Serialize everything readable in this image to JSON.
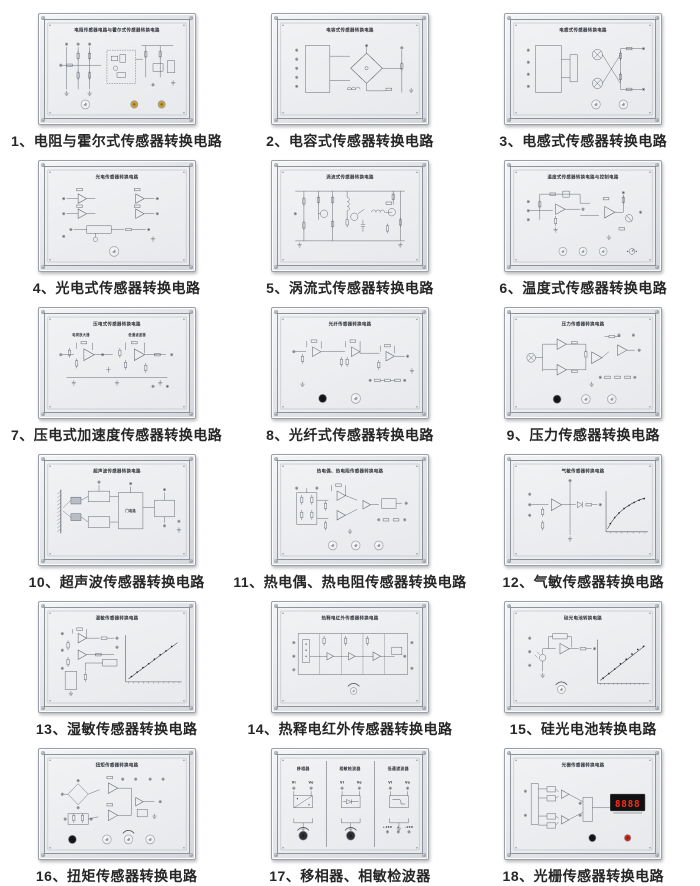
{
  "page": {
    "background": "#ffffff"
  },
  "colors": {
    "panel_frame": "#d9dbdf",
    "panel_plate": "#edeff2",
    "schematic_line": "#555a63",
    "caption_text": "#262626",
    "knob_white": "#eef0f2",
    "knob_yellow": "#c9a13b",
    "knob_black": "#17181a",
    "knob_dark": "#2f3136",
    "knob_red": "#d02418",
    "display_bg": "#111111",
    "display_digits_red": "#ff2a1a"
  },
  "panels": [
    {
      "caption": "1、电阻与霍尔式传感器转换电路",
      "title": "电阻传感器电路与霍尔式传感器转换电路",
      "motif": "hall",
      "knobs": [
        "white",
        "yellow",
        "yellow"
      ]
    },
    {
      "caption": "2、电容式传感器转换电路",
      "title": "电容式传感器转换电路",
      "motif": "bridge",
      "knobs": []
    },
    {
      "caption": "3、电感式传感器转换电路",
      "title": "电感式传感器转换电路",
      "motif": "inductive",
      "knobs": [
        "white",
        "white"
      ]
    },
    {
      "caption": "4、光电式传感器转换电路",
      "title": "光电传感器转换电路",
      "motif": "photo",
      "knobs": [
        "white"
      ]
    },
    {
      "caption": "5、涡流式传感器转换电路",
      "title": "涡流式传感器转换电路",
      "motif": "eddy",
      "knobs": []
    },
    {
      "caption": "6、温度式传感器转换电路",
      "title": "温度式传感器转换电路与控制电路",
      "motif": "temp",
      "knobs": [
        "white",
        "white",
        "white",
        "switch"
      ]
    },
    {
      "caption": "7、压电式加速度传感器转换电路",
      "title": "压电式传感器转换电路",
      "motif": "piezo",
      "knobs": []
    },
    {
      "caption": "8、光纤式传感器转换电路",
      "title": "光纤传感器转换电路",
      "motif": "fiber",
      "knobs": [
        "black",
        "white"
      ]
    },
    {
      "caption": "9、压力传感器转换电路",
      "title": "压力传感器转换电路",
      "motif": "pressure",
      "knobs": [
        "black",
        "white",
        "white"
      ]
    },
    {
      "caption": "10、超声波传感器转换电路",
      "title": "超声波传感器转换电路",
      "motif": "ultrasonic",
      "knobs": []
    },
    {
      "caption": "11、热电偶、热电阻传感器转换电路",
      "title": "热电偶、热电阻传感器转换电路",
      "motif": "thermo",
      "knobs": [
        "white",
        "white",
        "white"
      ]
    },
    {
      "caption": "12、气敏传感器转换电路",
      "title": "气敏传感器转换电路",
      "motif": "gas",
      "knobs": []
    },
    {
      "caption": "13、湿敏传感器转换电路",
      "title": "湿敏传感器转换电路",
      "motif": "humidity",
      "knobs": []
    },
    {
      "caption": "14、热释电红外传感器转换电路",
      "title": "热释电红外传感器转换电路",
      "motif": "pyro",
      "knobs": [
        "white"
      ]
    },
    {
      "caption": "15、硅光电池转换电路",
      "title": "硅光电池转换电路",
      "motif": "silicon",
      "knobs": [
        "white"
      ]
    },
    {
      "caption": "16、扭矩传感器转换电路",
      "title": "扭矩传感器转换电路",
      "motif": "torque",
      "knobs": [
        "black",
        "white",
        "white",
        "white"
      ]
    },
    {
      "caption": "17、移相器、相敏检波器",
      "title": "",
      "motif": "sections",
      "knobs": [
        "dark",
        "dark"
      ],
      "sections": [
        "移相器",
        "相敏检波器",
        "低通滤波器"
      ],
      "terminal_in_label": "Vi",
      "terminal_out_label": "Vo",
      "power_labels": [
        "+15V",
        "⊥",
        "-15V"
      ]
    },
    {
      "caption": "18、光栅传感器转换电路",
      "title": "光栅传感器转换电路",
      "motif": "grating",
      "knobs": [
        "black",
        "red"
      ],
      "display_value": "8888"
    }
  ]
}
